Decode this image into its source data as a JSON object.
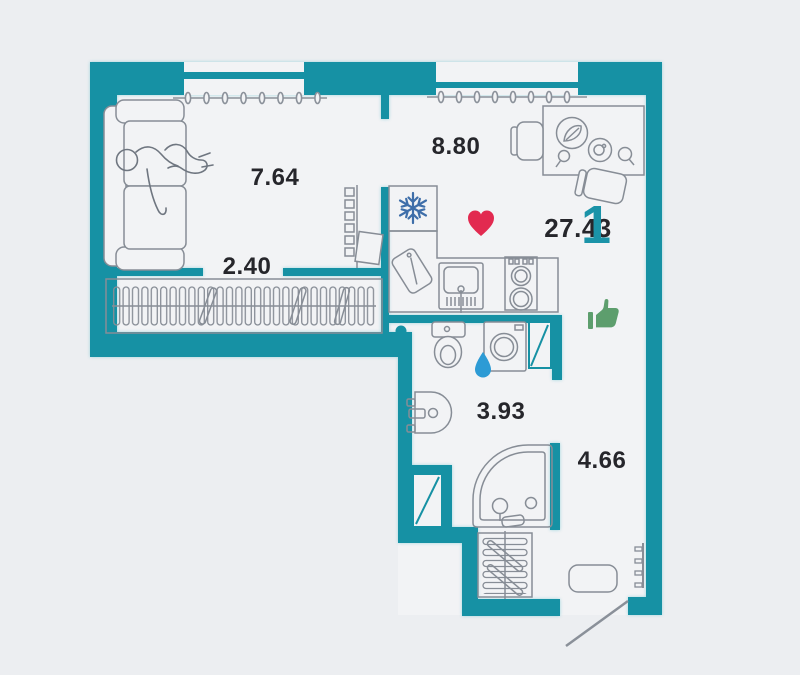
{
  "plan": {
    "unit_summary": {
      "rooms_count": "1",
      "total_area": "27.43"
    },
    "rooms": [
      {
        "name": "living-room",
        "area": "7.64"
      },
      {
        "name": "wardrobe",
        "area": "2.40"
      },
      {
        "name": "kitchen",
        "area": "8.80"
      },
      {
        "name": "bathroom",
        "area": "3.93"
      },
      {
        "name": "hallway",
        "area": "4.66"
      }
    ],
    "icons": {
      "heart": {
        "name": "heart-icon",
        "color": "#e22a50"
      },
      "thumbs_up": {
        "name": "thumbs-up-icon",
        "color": "#5d9e6d"
      },
      "snowflake": {
        "name": "snowflake-icon",
        "color": "#3e6ea9"
      },
      "water_drop": {
        "name": "water-drop-icon",
        "color": "#2d9bd5"
      }
    },
    "colors": {
      "wall": "#1691a4",
      "background": "#eceef1",
      "room_fill": "#f2f3f5",
      "label": "#26262b",
      "accent_digit": "#1b93a8",
      "furniture_outline": "#878d96"
    }
  }
}
